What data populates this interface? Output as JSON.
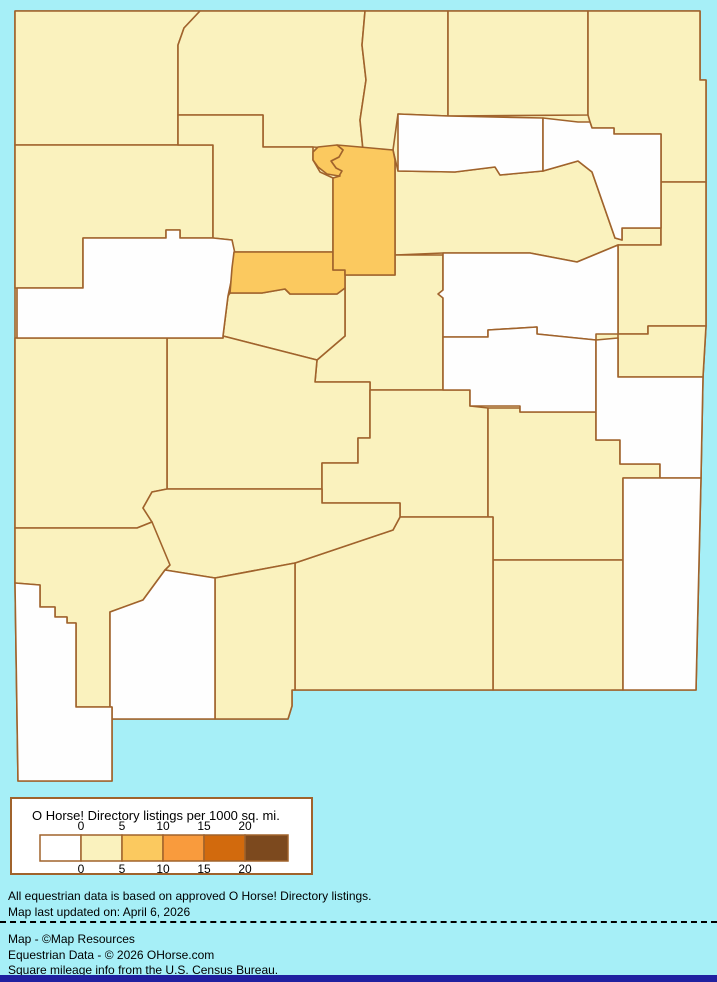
{
  "title": "O Horse! Directory listings per 1000 sq. mi. — New Mexico county choropleth",
  "colors": {
    "background": "#A6EFF7",
    "county_border": "#A0632C",
    "legend_border": "#A0632C",
    "footer_bar": "#2020A0",
    "text": "#000000"
  },
  "legend": {
    "title": "O Horse! Directory listings per 1000 sq. mi.",
    "ticks": [
      "0",
      "5",
      "10",
      "15",
      "20"
    ],
    "swatches": [
      "#FFFFFF",
      "#FAF2BE",
      "#FBC95F",
      "#F99B3D",
      "#D26A0D",
      "#7C491E"
    ],
    "swatch_border": "#A0632C"
  },
  "notes": {
    "line1": "All equestrian data is based on approved O Horse! Directory listings.",
    "line2": "Map last updated on: April 6, 2026"
  },
  "credits": {
    "line1": "Map - ©Map Resources",
    "line2": "Equestrian Data - © 2026 OHorse.com",
    "line3": "Square mileage info from the U.S. Census Bureau."
  },
  "map": {
    "region": "New Mexico counties",
    "base_fill": "#FAF2BE",
    "stroke": "#A0632C",
    "counties": [
      {
        "name": "San Juan",
        "bucket": "0-5",
        "fill": "#FAF2BE"
      },
      {
        "name": "Rio Arriba",
        "bucket": "0-5",
        "fill": "#FAF2BE"
      },
      {
        "name": "Taos",
        "bucket": "0-5",
        "fill": "#FAF2BE"
      },
      {
        "name": "Colfax",
        "bucket": "0-5",
        "fill": "#FAF2BE"
      },
      {
        "name": "Union",
        "bucket": "0-5",
        "fill": "#FAF2BE"
      },
      {
        "name": "San Miguel",
        "bucket": "0-5",
        "fill": "#FAF2BE"
      },
      {
        "name": "Quay",
        "bucket": "0-5",
        "fill": "#FAF2BE"
      },
      {
        "name": "Curry",
        "bucket": "0-5",
        "fill": "#FAF2BE"
      },
      {
        "name": "McKinley",
        "bucket": "0-5",
        "fill": "#FAF2BE"
      },
      {
        "name": "Sandoval",
        "bucket": "0-5",
        "fill": "#FAF2BE"
      },
      {
        "name": "Torrance",
        "bucket": "0-5",
        "fill": "#FAF2BE"
      },
      {
        "name": "Valencia",
        "bucket": "0-5",
        "fill": "#FAF2BE"
      },
      {
        "name": "Socorro",
        "bucket": "0-5",
        "fill": "#FAF2BE"
      },
      {
        "name": "Catron",
        "bucket": "0-5",
        "fill": "#FAF2BE"
      },
      {
        "name": "Lincoln",
        "bucket": "0-5",
        "fill": "#FAF2BE"
      },
      {
        "name": "Chaves",
        "bucket": "0-5",
        "fill": "#FAF2BE"
      },
      {
        "name": "Eddy",
        "bucket": "0-5",
        "fill": "#FAF2BE"
      },
      {
        "name": "Otero",
        "bucket": "0-5",
        "fill": "#FAF2BE"
      },
      {
        "name": "Sierra",
        "bucket": "0-5",
        "fill": "#FAF2BE"
      },
      {
        "name": "Grant",
        "bucket": "0-5",
        "fill": "#FAF2BE"
      },
      {
        "name": "Doña Ana",
        "bucket": "0-5",
        "fill": "#FAF2BE"
      },
      {
        "name": "Mora",
        "bucket": "0",
        "fill": "#FEFEFE"
      },
      {
        "name": "Harding",
        "bucket": "0",
        "fill": "#FEFEFE"
      },
      {
        "name": "Cibola",
        "bucket": "0",
        "fill": "#FEFEFE"
      },
      {
        "name": "Guadalupe",
        "bucket": "0",
        "fill": "#FEFEFE"
      },
      {
        "name": "De Baca",
        "bucket": "0",
        "fill": "#FEFEFE"
      },
      {
        "name": "Roosevelt",
        "bucket": "0",
        "fill": "#FEFEFE"
      },
      {
        "name": "Lea",
        "bucket": "0",
        "fill": "#FEFEFE"
      },
      {
        "name": "Luna",
        "bucket": "0",
        "fill": "#FEFEFE"
      },
      {
        "name": "Hidalgo",
        "bucket": "0",
        "fill": "#FEFEFE"
      },
      {
        "name": "Bernalillo",
        "bucket": "5-10",
        "fill": "#FBC95F"
      },
      {
        "name": "Santa Fe",
        "bucket": "5-10",
        "fill": "#FBC95F"
      },
      {
        "name": "Los Alamos",
        "bucket": "5-10",
        "fill": "#FBC95F"
      }
    ]
  }
}
